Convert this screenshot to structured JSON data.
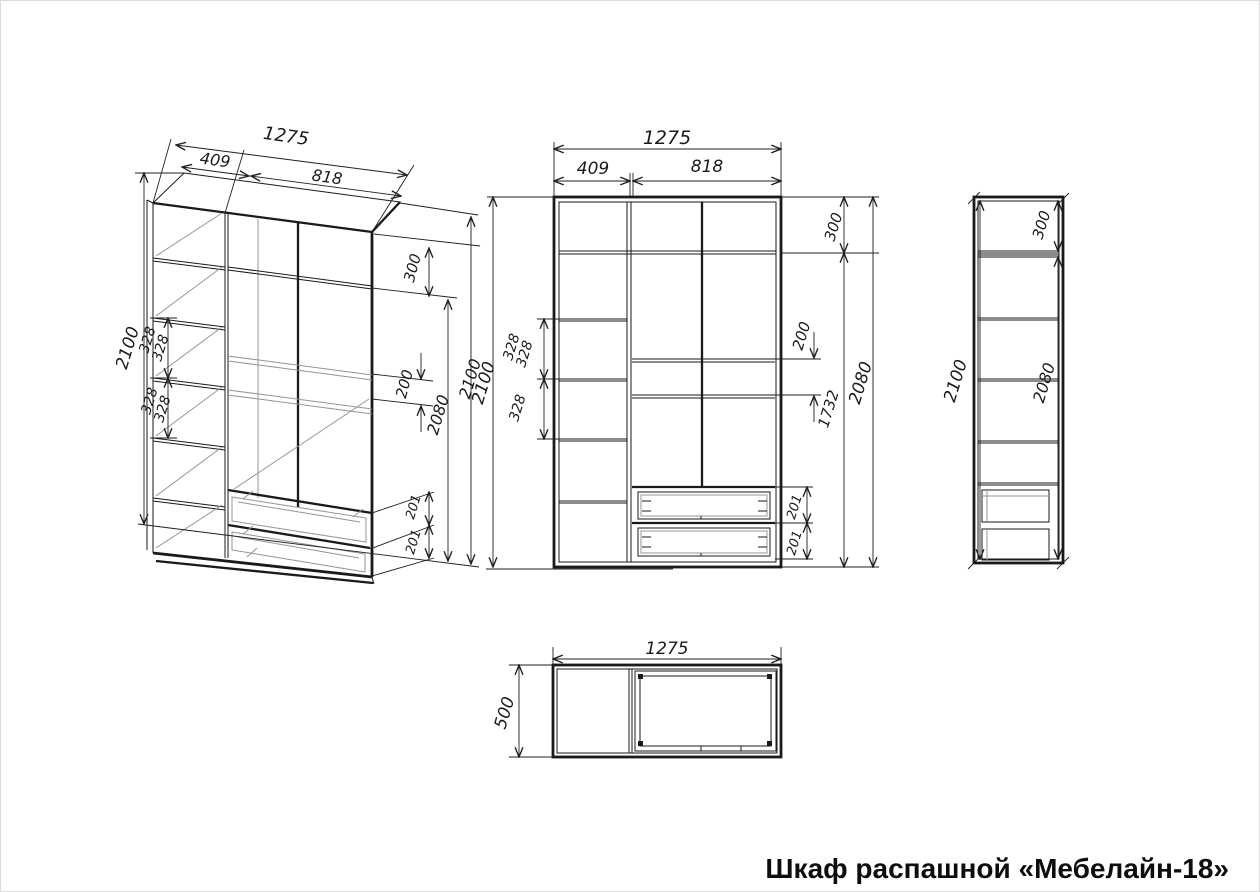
{
  "title": "Шкаф распашной «Мебелайн-18»",
  "iso": {
    "width_total": "1275",
    "width_left": "409",
    "width_right": "818",
    "height_left": "2100",
    "shelf_gap_1": "328",
    "shelf_gap_1b": "328",
    "shelf_gap_2": "328",
    "shelf_gap_2b": "328",
    "top_section": "300",
    "rail_gap": "200",
    "height_inner": "2080",
    "height_right": "2100",
    "drawer_1": "201",
    "drawer_2": "201"
  },
  "front": {
    "width_total": "1275",
    "width_left": "409",
    "width_right": "818",
    "height": "2100",
    "shelf_gap_1": "328",
    "shelf_gap_1b": "328",
    "shelf_gap_2": "328",
    "top_section": "300",
    "rail_gap": "200",
    "lower_section": "1732",
    "height_inner": "2080",
    "drawer_1": "201",
    "drawer_2": "201"
  },
  "side": {
    "height": "2100",
    "top_section": "300",
    "height_inner": "2080"
  },
  "plan": {
    "width": "1275",
    "depth": "500"
  }
}
